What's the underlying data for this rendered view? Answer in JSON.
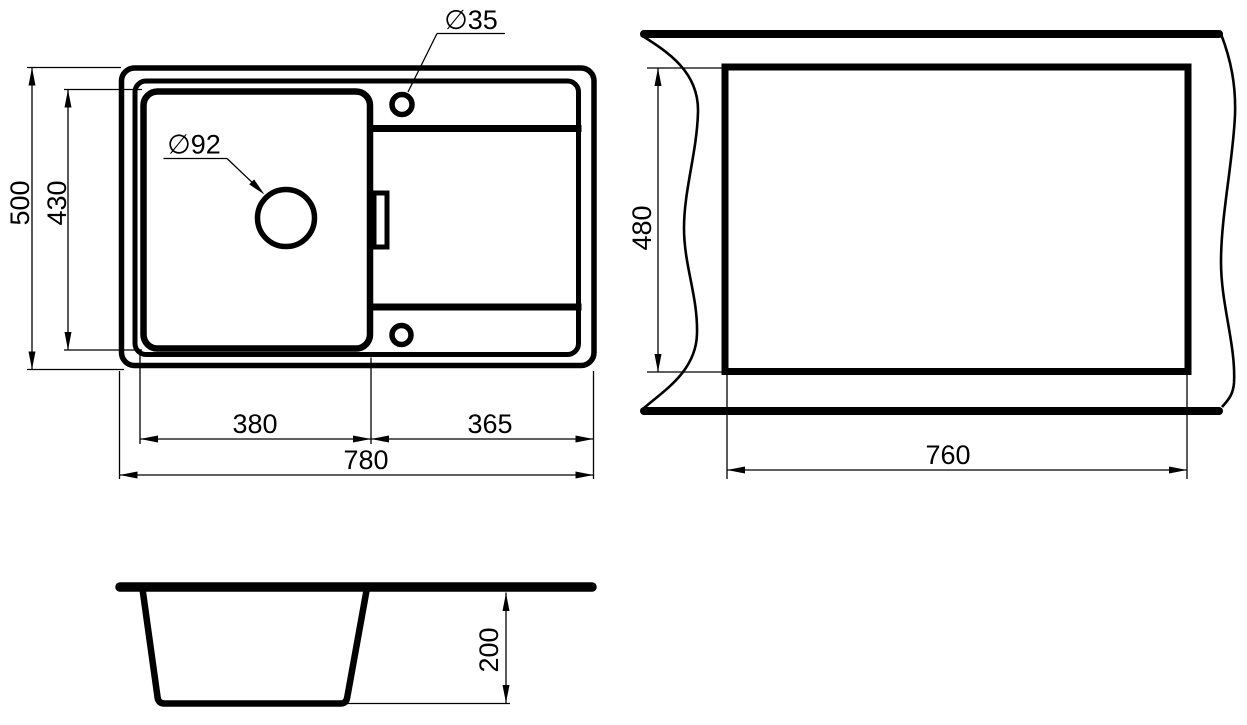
{
  "drawing": {
    "description": "Kitchen sink technical dimension drawing, three views",
    "units": "mm",
    "top_view": {
      "labels": {
        "faucet_hole_diameter": "∅35",
        "drain_hole_diameter": "∅92",
        "overall_depth": "500",
        "bowl_depth": "430",
        "bowl_width": "380",
        "drainboard_width": "365",
        "overall_width": "780"
      }
    },
    "cutout_view": {
      "labels": {
        "cutout_depth": "480",
        "cutout_width": "760"
      }
    },
    "section_view": {
      "labels": {
        "bowl_height": "200"
      }
    },
    "colors": {
      "line": "#000000",
      "background": "#ffffff"
    }
  }
}
